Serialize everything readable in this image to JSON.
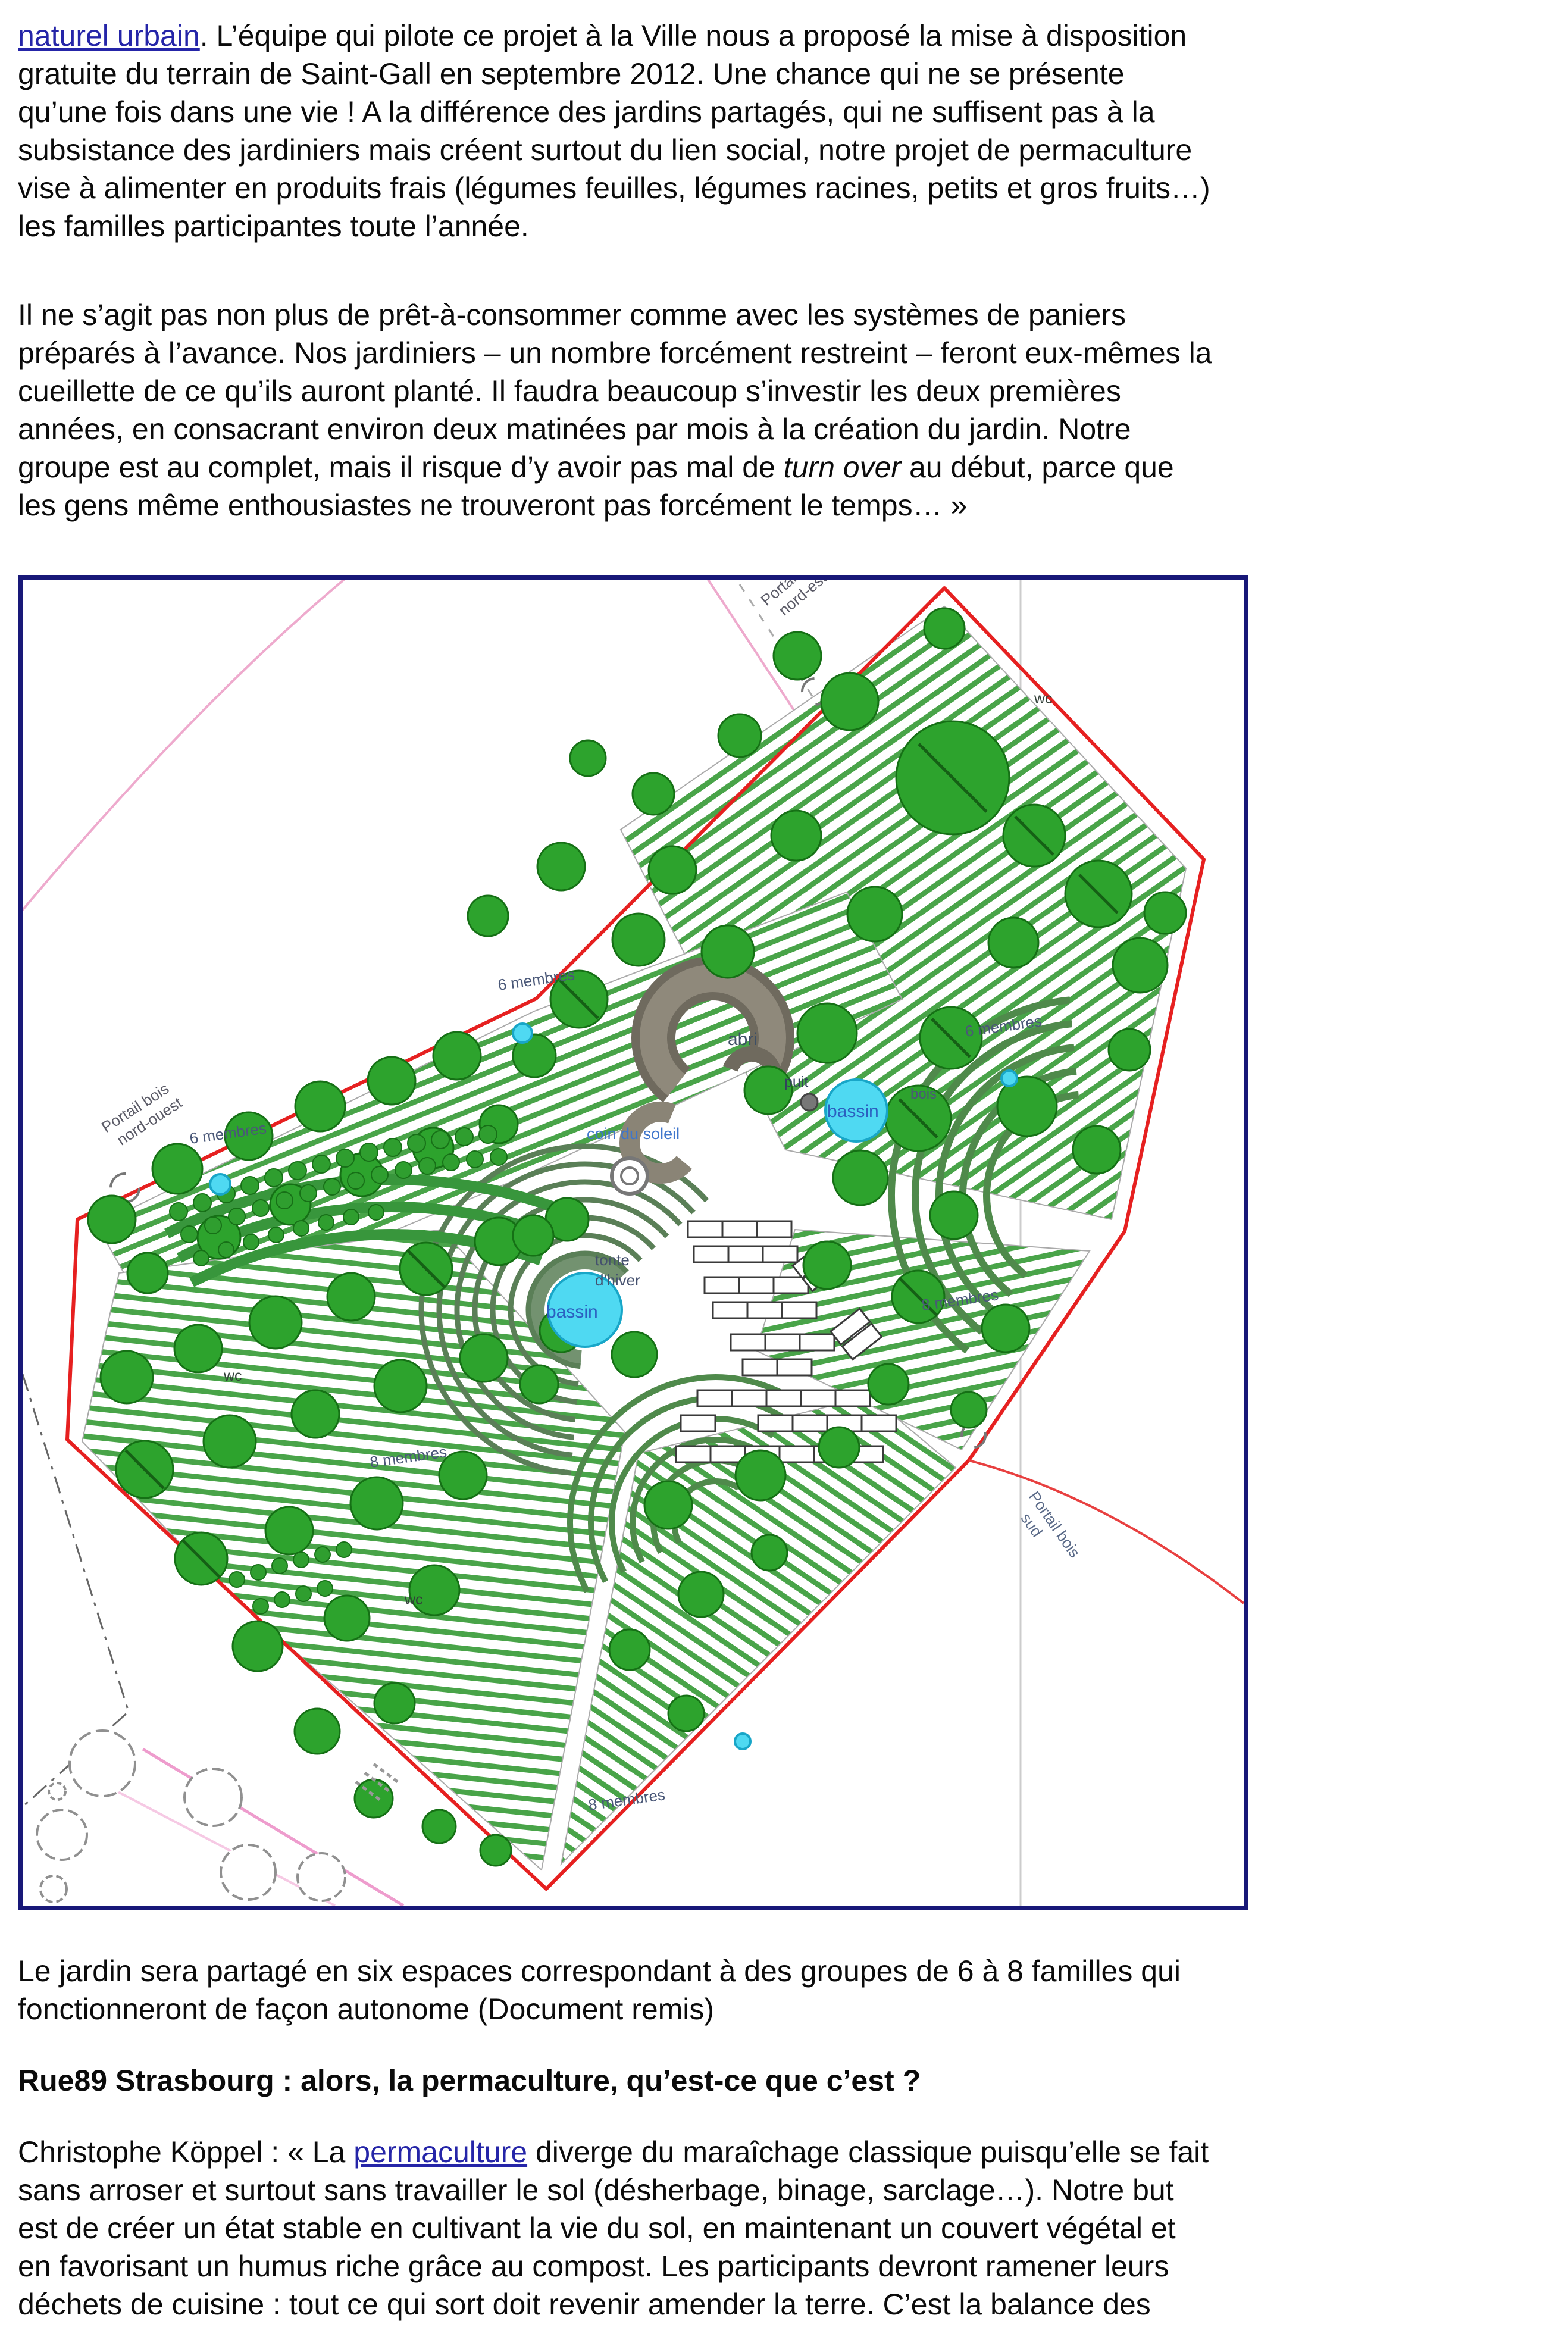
{
  "page": {
    "background": "#ffffff",
    "text_color": "#0b0b0b",
    "link_color": "#2525a8"
  },
  "paragraphs": [
    {
      "name": "intro",
      "segments": [
        {
          "kind": "link",
          "name": "link-naturel-urbain",
          "text": "naturel urbain"
        },
        {
          "kind": "plain",
          "text": ". L’équipe qui pilote ce projet à la Ville nous a proposé la mise à disposition"
        },
        {
          "kind": "break"
        },
        {
          "kind": "plain",
          "text": "gratuite du terrain de Saint-Gall en septembre 2012. Une chance qui ne se présente"
        },
        {
          "kind": "break"
        },
        {
          "kind": "plain",
          "text": "qu’une fois dans une vie ! A la différence des jardins partagés, qui ne suffisent pas à la"
        },
        {
          "kind": "break"
        },
        {
          "kind": "plain",
          "text": "subsistance des jardiniers mais créent surtout du lien social, notre projet de permaculture"
        },
        {
          "kind": "break"
        },
        {
          "kind": "plain",
          "text": "vise à alimenter en produits frais (légumes feuilles, légumes racines, petits et gros fruits…)"
        },
        {
          "kind": "break"
        },
        {
          "kind": "plain",
          "text": "les familles participantes toute l’année."
        }
      ]
    },
    {
      "name": "quote",
      "segments": [
        {
          "kind": "plain",
          "text": "Il ne s’agit pas non plus de prêt-à-consommer comme avec les systèmes de paniers"
        },
        {
          "kind": "break"
        },
        {
          "kind": "plain",
          "text": "préparés à l’avance. Nos jardiniers – un nombre forcément restreint – feront eux-mêmes la"
        },
        {
          "kind": "break"
        },
        {
          "kind": "plain",
          "text": "cueillette de ce qu’ils auront planté. Il faudra beaucoup s’investir les deux premières"
        },
        {
          "kind": "break"
        },
        {
          "kind": "plain",
          "text": "années, en consacrant environ deux matinées par mois à la création du jardin. Notre"
        },
        {
          "kind": "break"
        },
        {
          "kind": "plain",
          "text": "groupe est au complet, mais il risque d’y avoir pas mal de "
        },
        {
          "kind": "italic",
          "text": "turn over"
        },
        {
          "kind": "plain",
          "text": " au début, parce que"
        },
        {
          "kind": "break"
        },
        {
          "kind": "plain",
          "text": "les gens même enthousiastes ne trouveront pas forcément le temps… »"
        }
      ]
    },
    {
      "name": "answer",
      "segments": [
        {
          "kind": "plain",
          "text": "Christophe Köppel : « La "
        },
        {
          "kind": "link",
          "name": "link-permaculture",
          "text": "permaculture"
        },
        {
          "kind": "plain",
          "text": " diverge du maraîchage classique puisqu’elle se fait"
        },
        {
          "kind": "break"
        },
        {
          "kind": "plain",
          "text": "sans arroser et surtout sans travailler le sol (désherbage, binage, sarclage…). Notre but"
        },
        {
          "kind": "break"
        },
        {
          "kind": "plain",
          "text": "est de créer un état stable en cultivant la vie du sol, en maintenant un couvert végétal et"
        },
        {
          "kind": "break"
        },
        {
          "kind": "plain",
          "text": "en favorisant un humus riche grâce au compost. Les participants devront ramener leurs"
        },
        {
          "kind": "break"
        },
        {
          "kind": "plain",
          "text": "déchets de cuisine : tout ce qui sort doit revenir amender la terre. C’est la balance des"
        }
      ]
    }
  ],
  "caption": {
    "segments": [
      {
        "kind": "plain",
        "text": "Le jardin sera partagé en six espaces correspondant à des groupes de 6 à 8 familles qui"
      },
      {
        "kind": "break"
      },
      {
        "kind": "plain",
        "text": "fonctionneront de façon autonome (Document remis)"
      }
    ]
  },
  "heading": {
    "text": "Rue89 Strasbourg : alors, la permaculture, qu’est-ce que c’est ?"
  },
  "figure": {
    "colors": {
      "frame": "#181878",
      "boundary": "#e62020",
      "tree": "#2da32d",
      "bed_stripe": "#49a449",
      "water": "#4fd9f2",
      "context_pink": "#eeaacd"
    },
    "labels": {
      "portail_nord_ouest_line1": "Portail bois",
      "portail_nord_ouest_line2": "nord-ouest",
      "portail_nord_est_line1": "Portail bois",
      "portail_nord_est_line2": "nord-est",
      "portail_sud_line1": "Portail bois",
      "portail_sud_line2": "sud",
      "abri": "abri",
      "coin_du_soleil": "coin du soleil",
      "puit": "puit",
      "bassin": "bassin",
      "tonte_line1": "tonte",
      "tonte_line2": "d'hiver",
      "groupe_6": "6 membres",
      "groupe_8": "8 membres",
      "wc": "wc",
      "bois": "bois"
    }
  }
}
